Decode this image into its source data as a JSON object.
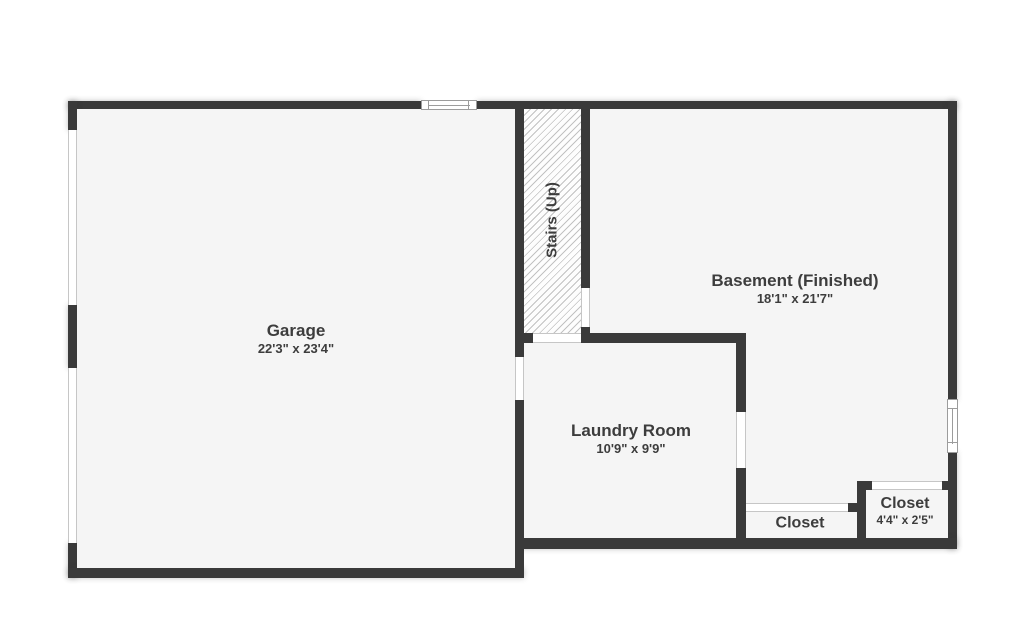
{
  "rooms": {
    "garage": {
      "name": "Garage",
      "dims": "22'3\" x 23'4\""
    },
    "stairs": {
      "name": "Stairs (Up)"
    },
    "basement": {
      "name": "Basement (Finished)",
      "dims": "18'1\" x 21'7\""
    },
    "laundry": {
      "name": "Laundry Room",
      "dims": "10'9\" x 9'9\""
    },
    "closet_middle": {
      "name": "Closet"
    },
    "closet_right": {
      "name": "Closet",
      "dims": "4'4\" x 2'5\""
    }
  },
  "colors": {
    "wall": "#3a3a3a",
    "floor": "#f5f5f5",
    "hatch_line": "#c2c2c2",
    "text": "#3d3d3d",
    "window_frame": "#9c9c9c",
    "background": "#ffffff"
  }
}
